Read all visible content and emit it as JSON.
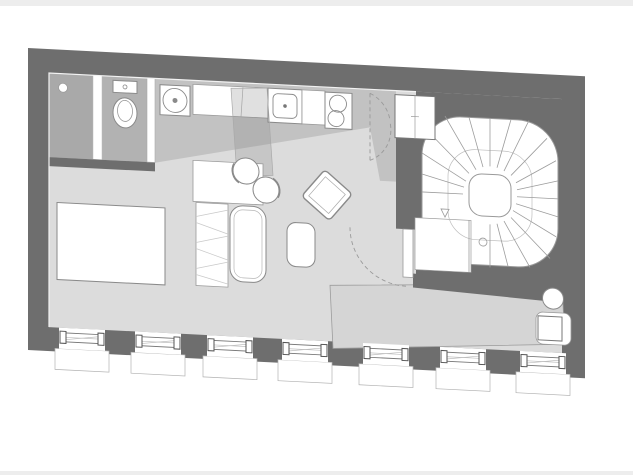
{
  "meta": {
    "title": "studio-apartment-floor-plan",
    "kind": "architectural plan drawing, no text labels"
  },
  "colors": {
    "paper": "#ffffff",
    "page_edge": "#ededed",
    "wall": "#6e6e6e",
    "floor_living": "#dcdcdc",
    "floor_kitchen": "#c2c2c2",
    "floor_bath": "#b2b2b2",
    "floor_shower": "#a9a9a9",
    "corridor_panel": "#d5d5d5",
    "fixture": "#ffffff",
    "outline": "#8a8a8a",
    "overlay": "rgba(130,130,130,0.25)"
  },
  "plan": {
    "shear_deg": 2.9,
    "rooms": [
      {
        "name": "bathroom",
        "position": "top-left"
      },
      {
        "name": "kitchen-strip",
        "position": "top-center"
      },
      {
        "name": "living-room",
        "position": "center-left"
      },
      {
        "name": "entry-vestibule",
        "position": "top-right-of-kitchen"
      },
      {
        "name": "spiral-stair-hall",
        "position": "right"
      },
      {
        "name": "window-gallery-corridor",
        "position": "bottom-right"
      }
    ],
    "fixtures": [
      "shower",
      "floor-drain",
      "toilet",
      "bathroom-door",
      "washing-machine",
      "kitchen-counter",
      "kitchen-sink",
      "cooktop-two-burners",
      "double-swing-door",
      "tall-cabinet",
      "spiral-staircase",
      "stair-landing",
      "entry-door-with-swing-arc",
      "bed",
      "wardrobe",
      "dining-table",
      "round-chair",
      "round-chair",
      "sofa",
      "armchair-rotated",
      "coffee-table",
      "round-stool",
      "desk-with-chair",
      "mezzanine-overlay"
    ],
    "windows": {
      "count": 7,
      "style": "casement with exterior sill, between dark wall piers"
    },
    "stair": {
      "tread_lines": 19,
      "newel": "rounded-square",
      "direction_arrow": true
    }
  }
}
